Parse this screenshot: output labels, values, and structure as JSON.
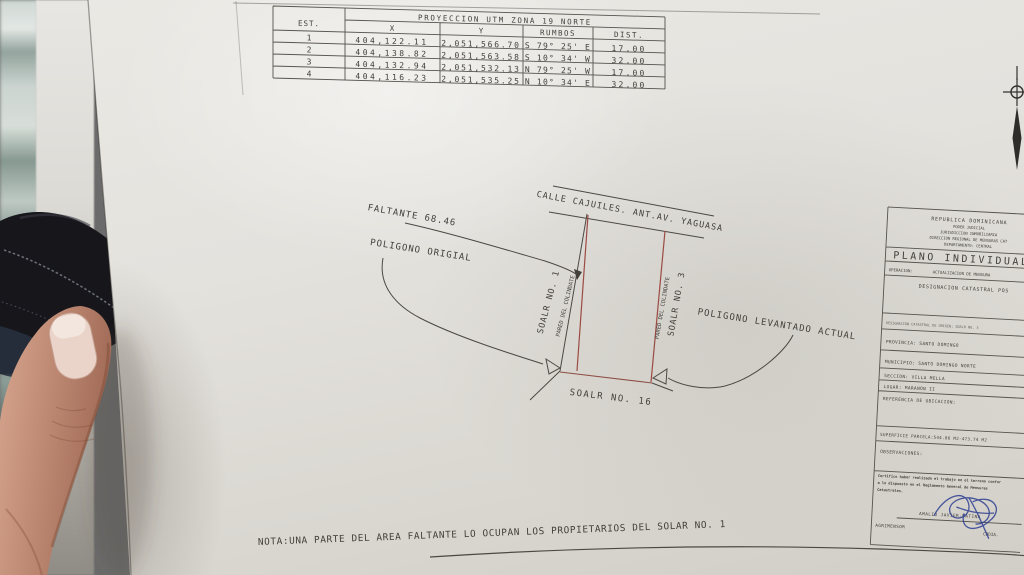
{
  "coordinate_table": {
    "title": "PROYECCION UTM ZONA 19 NORTE",
    "col_est": "EST.",
    "col_x": "X",
    "col_y": "Y",
    "col_rumbos": "RUMBOS",
    "col_dist": "DIST.",
    "rows": [
      {
        "est": "1",
        "x": "404,122.11",
        "y": "2,051,566.70",
        "rumbos": "S 79° 25' E",
        "dist": "17.00"
      },
      {
        "est": "2",
        "x": "404,138.82",
        "y": "2,051,563.58",
        "rumbos": "S 10° 34' W",
        "dist": "32.00"
      },
      {
        "est": "3",
        "x": "404,132.94",
        "y": "2,051,532.13",
        "rumbos": "N 79° 25' W",
        "dist": "17.00"
      },
      {
        "est": "4",
        "x": "404,116.23",
        "y": "2,051,535.25",
        "rumbos": "N 10° 34' E",
        "dist": "32.00"
      }
    ]
  },
  "drawing": {
    "street_label": "CALLE CAJUILES. ANT.AV. YAGUASA",
    "faltante_label": "FALTANTE 68.46",
    "poligono_original_label": "POLIGONO ORIGIAL",
    "poligono_levantado_label": "POLIGONO LEVANTADO ACTUAL",
    "solar1_label": "SOALR NO. 1",
    "solar3_label": "SOALR NO. 3",
    "solar16_label": "SOALR NO. 16",
    "pared_left_label": "PARED DEL COLINDATE",
    "pared_right_label": "PARED DEL COLINDATE"
  },
  "title_block": {
    "header_line1": "REPUBLICA DOMINICANA",
    "header_line2": "PODER JUDICIAL",
    "header_line3": "JURISDICCION INMOBILIARIA",
    "header_line4": "DIRECCION REGIONAL DE MENSURAS CAT",
    "header_line5": "DEPARTAMENTO: CENTRAL",
    "plan_type": "PLANO INDIVIDUAL",
    "operacion_label": "OPERACION:",
    "operacion_value": "ACTUALIZACION DE MENSURA",
    "designacion_posicional": "DESIGNACION CATASTRAL POS",
    "designacion_origen": "DESIGNACION CATASTRAL DE ORIGEN: SOALR NO. 3",
    "provincia": "PROVINCIA: SANTO DOMINGO",
    "municipio": "MUNICIPIO: SANTO DOMINGO NORTE",
    "seccion": "SECCION: VILLA MELLA",
    "lugar": "LUGAR:    MARANON II",
    "referencia": "REFERENCIA DE UBICACION:",
    "superficie": "SUPERFICIE PARCELA:544.06 M2-473.74 M2",
    "observaciones": "OBSERVACIONES:",
    "cert_line1": "Certifico haber realizado el trabajo en el terreno confor",
    "cert_line2": "a lo dispuesto en el Reglamento General de Mensuras",
    "cert_line3": "Catastrales.",
    "surveyor_name": "AMALIO JAVIER-MATINA",
    "surveyor_title": "AGRIMENSOR",
    "surveyor_org": "CODIA."
  },
  "note": "NOTA:UNA PARTE DEL AREA FALTANTE LO OCUPAN LOS PROPIETARIOS DEL SOLAR NO. 1",
  "colors": {
    "red_line": "#9b4a42",
    "ink": "#4c4944",
    "signature_blue": "#2e3f92",
    "paper": "#e4e2dd"
  }
}
